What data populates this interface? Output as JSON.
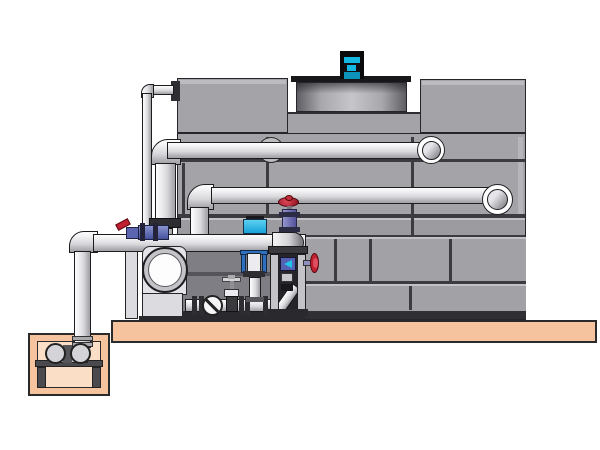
{
  "scene": {
    "type": "technical-illustration",
    "subject": "Closed-circuit cooling tower with circulation pump skid, piping and sump pit",
    "background": "#ffffff"
  },
  "palette": {
    "tank_gray": "#a4a4a8",
    "tank_band": "#9c9ca0",
    "brick_gray": "#a2a2a6",
    "alcove_gray": "#7e7e84",
    "alcove_top": "#8e8e94",
    "seam_dark": "#3c3c40",
    "bottom_rail": "#303034",
    "edge_light": "#b6b6ba",
    "deck_black": "#18181a",
    "motor_cyan": "#14b8e2",
    "motor_cyan_dark": "#0d93ba",
    "pipe_light": "#ececee",
    "platform_tan": "#f5c49e",
    "pit_inner_tan": "#fadec6",
    "ground_outline": "#2a2a2a",
    "valve_red": "#c02030",
    "valve_purple_light": "#9494cc",
    "valve_purple_dark": "#52529a",
    "pump_blue_light": "#8a94d0",
    "pump_blue_dark": "#46529c",
    "solenoid_blue": "#5560b2",
    "arrow_cyan": "#22c4ea",
    "saddle_cyan": "#28aee4",
    "strainer_blue": "#2f6fc0",
    "hardware_dark": "#2e2e32",
    "stand_dark": "#4a4a4e",
    "pump_white": "#fdfdfe"
  },
  "components": [
    {
      "name": "cooling-tower-casing",
      "description": "Large gray panelled casing with seam lines"
    },
    {
      "name": "fan-cowl",
      "description": "Recessed cylindrical fan cowl on black deck plate"
    },
    {
      "name": "fan-motor",
      "description": "Cyan and black motor on top of fan deck"
    },
    {
      "name": "upper-inlet-pipe",
      "description": "Horizontal pipe entering casing through ringed inlet"
    },
    {
      "name": "lower-inlet-pipe",
      "description": "Second horizontal pipe with ringed inlet lower right"
    },
    {
      "name": "makeup-line",
      "description": "Thin vertical make-up water line flanged to upper left box"
    },
    {
      "name": "riser-pipe",
      "description": "Large vertical riser from suction line to upper pipe"
    },
    {
      "name": "suction-line",
      "description": "Horizontal suction pipe from sump to skid"
    },
    {
      "name": "sump-pit",
      "description": "Tan concrete pit with submerged pump on stand"
    },
    {
      "name": "sump-pump",
      "description": "Small twin-cylinder pump inside pit"
    },
    {
      "name": "circulation-pump",
      "description": "White volute pump with round inlet on skid"
    },
    {
      "name": "check-valve",
      "description": "Wafer check valve disk with diagonal slash"
    },
    {
      "name": "gate-valve",
      "description": "Small gate valve with tee handle on discharge run"
    },
    {
      "name": "suction-strainer",
      "description": "Blue yoke strainer hanging under suction pipe"
    },
    {
      "name": "pipe-saddle-sensor",
      "description": "Cyan saddle-mounted sensor on suction pipe"
    },
    {
      "name": "control-valve",
      "description": "Purple valve with red handwheel on pipe-end elbow"
    },
    {
      "name": "dosing-column",
      "description": "Frame column with solenoid, side handwheel and drain elbow"
    },
    {
      "name": "lever-valve",
      "description": "Red lever valve with blue dosing pump on suction pipe"
    },
    {
      "name": "platform",
      "description": "Tan concrete platform slab under equipment"
    }
  ]
}
